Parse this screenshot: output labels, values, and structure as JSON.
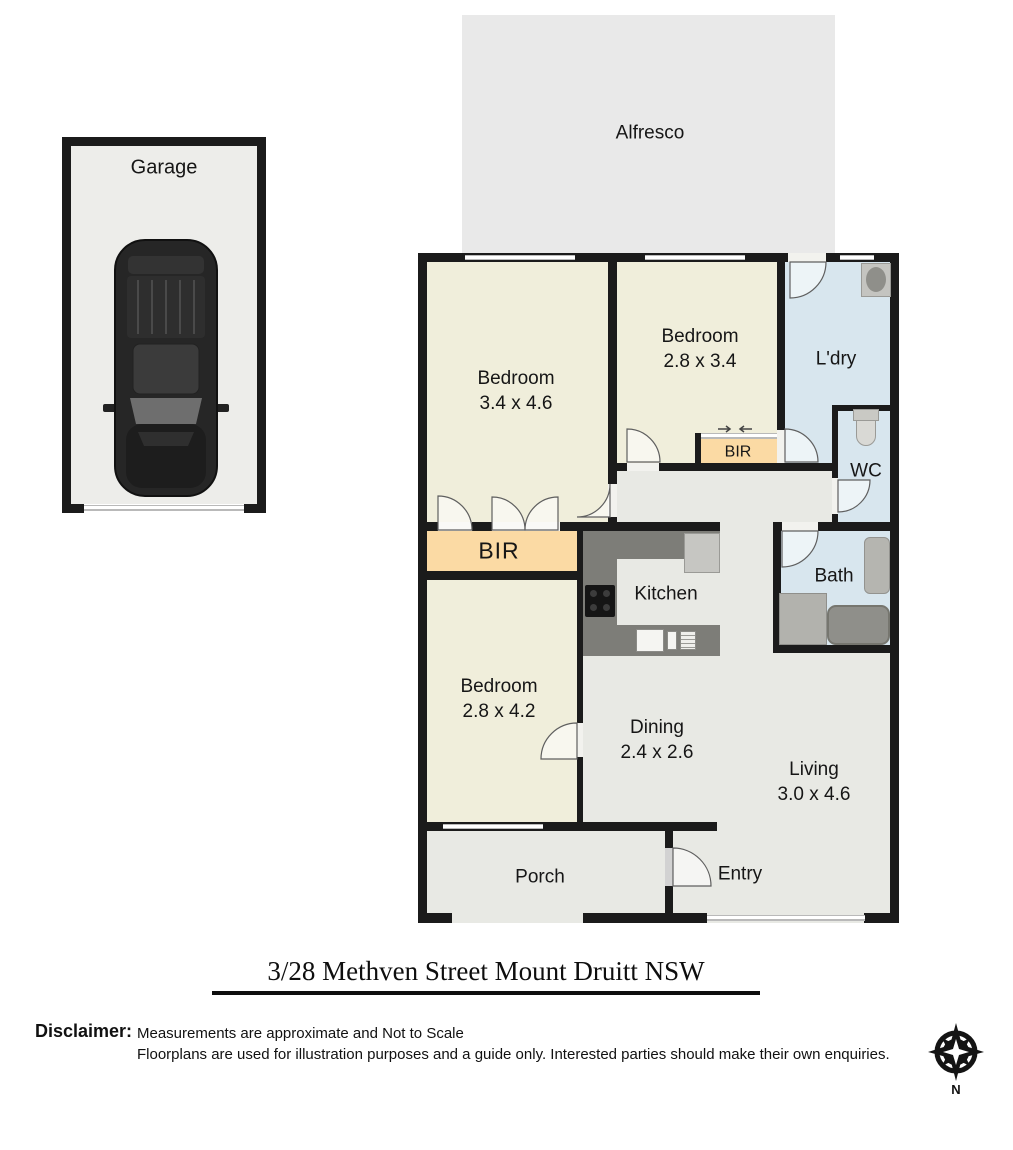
{
  "title": {
    "text": "3/28 Methven Street Mount Druitt  NSW"
  },
  "disclaimer": {
    "heading": "Disclaimer:",
    "line1": "Measurements are approximate and Not to Scale",
    "line2": "Floorplans are used for illustration purposes and a guide only.   Interested parties should make their own enquiries."
  },
  "compass": {
    "label": "N"
  },
  "areas": {
    "garage": {
      "label": "Garage"
    },
    "alfresco": {
      "label": "Alfresco"
    },
    "bedroom1": {
      "label": "Bedroom",
      "dims": "3.4 x 4.6"
    },
    "bedroom2": {
      "label": "Bedroom",
      "dims": "2.8 x 3.4"
    },
    "bedroom3": {
      "label": "Bedroom",
      "dims": "2.8 x 4.2"
    },
    "bir_main": {
      "label": "BIR"
    },
    "bir_small": {
      "label": "BIR"
    },
    "laundry": {
      "label": "L'dry"
    },
    "wc": {
      "label": "WC"
    },
    "bath": {
      "label": "Bath"
    },
    "kitchen": {
      "label": "Kitchen"
    },
    "dining": {
      "label": "Dining",
      "dims": "2.4 x 2.6"
    },
    "living": {
      "label": "Living",
      "dims": "3.0 x 4.6"
    },
    "porch": {
      "label": "Porch"
    },
    "entry": {
      "label": "Entry"
    }
  },
  "colors": {
    "wall": "#1b1b1b",
    "bedroom_fill": "#f0eedb",
    "wet_area_fill": "#d8e6ee",
    "robe_fill": "#fbdaa4",
    "floor_fill": "#e8e9e4",
    "outdoor_fill": "#e9e9e9",
    "counter": "#7d7d78"
  }
}
